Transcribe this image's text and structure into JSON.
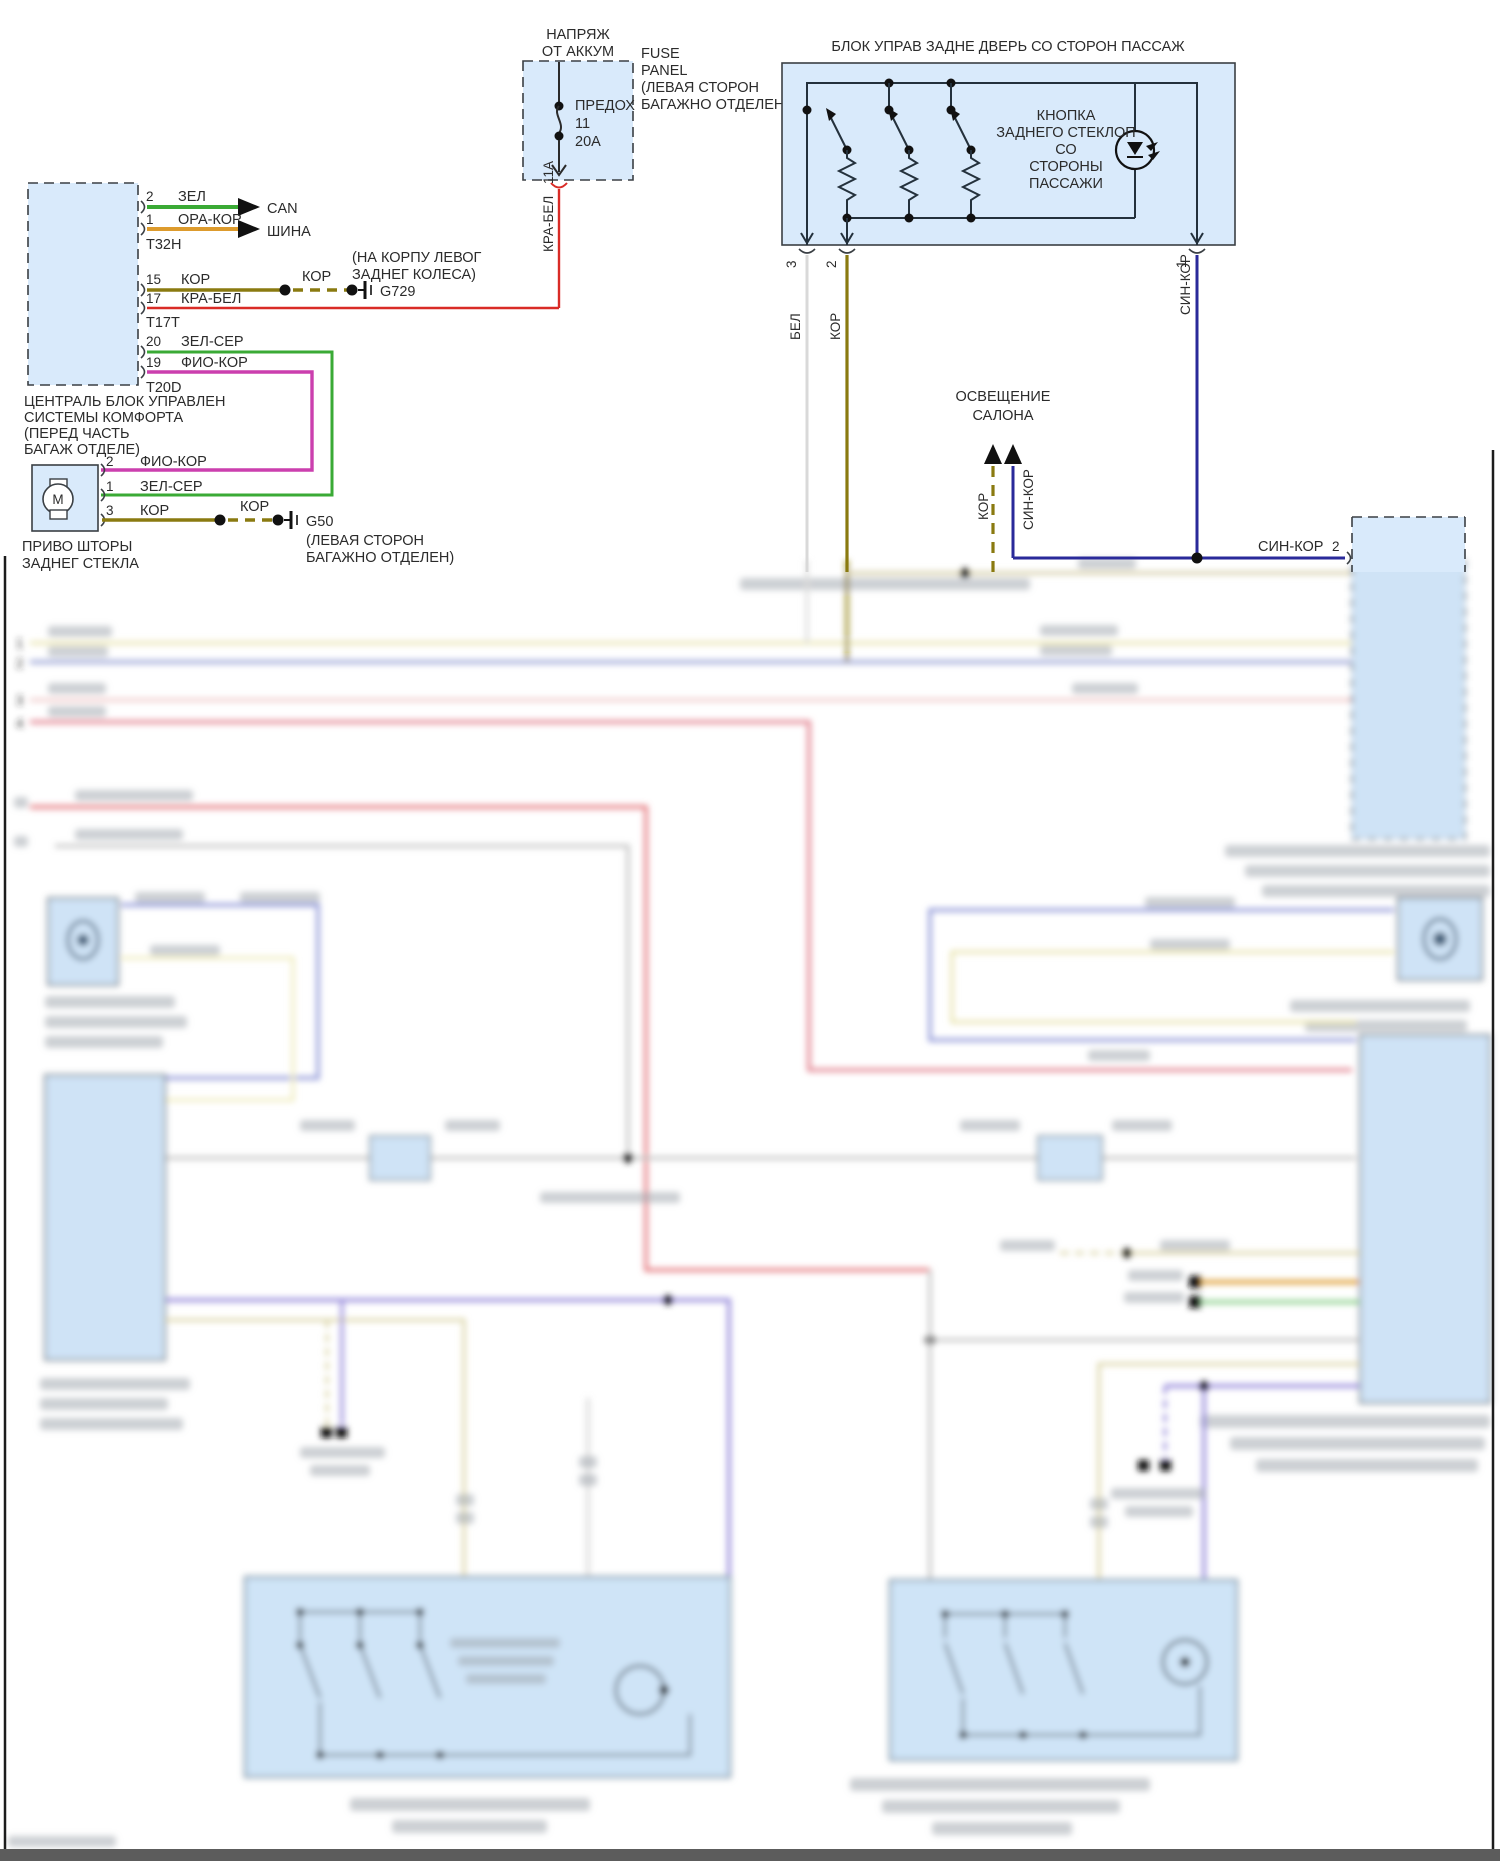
{
  "colors": {
    "green": "#3aaa35",
    "orange": "#dd9b2d",
    "olive": "#8a7a10",
    "red": "#d92b26",
    "magenta": "#cb3fae",
    "blue": "#2a2a9a",
    "white_wire": "#d9d9d9",
    "block_fill": "#d9eafb",
    "blur_fill": "#cfe3f6",
    "row_yellow": "#e6e1a6",
    "row_periwinkle": "#96a0d4",
    "row_palepink": "#efc7c7",
    "row_crimson": "#e2808e",
    "row_red": "#e2696f",
    "row_gray": "#bcbcbc",
    "violet": "#8d80d8",
    "beige": "#d9d2a2"
  },
  "fuse_panel": {
    "supply": [
      "НАПРЯЖ",
      "ОТ АККУМ"
    ],
    "fuse": [
      "ПРЕДОХ",
      "11",
      "20А"
    ],
    "panel": [
      "FUSE",
      "PANEL",
      "(ЛЕВАЯ СТОРОН",
      "БАГАЖНО ОТДЕЛЕН)"
    ],
    "amp": "11А",
    "wire": "КРА-БЕЛ"
  },
  "comfort_block": {
    "title": [
      "ЦЕНТРАЛЬ БЛОК УПРАВЛЕН",
      "СИСТЕМЫ КОМФОРТА",
      "(ПЕРЕД ЧАСТЬ",
      "БАГАЖ ОТДЕЛЕ)"
    ],
    "conn1": "T32H",
    "conn2": "T17T",
    "conn3": "T20D",
    "pins": {
      "p2": "2",
      "p1": "1",
      "p15": "15",
      "p17": "17",
      "p20": "20",
      "p19": "19"
    },
    "wires": {
      "w2": "ЗЕЛ",
      "w1": "ОРА-КОР",
      "w15": "КОР",
      "w17": "КРА-БЕЛ",
      "w20": "ЗЕЛ-СЕР",
      "w19": "ФИО-КОР"
    },
    "bus": [
      "CAN",
      "ШИНА"
    ],
    "ground": {
      "label": "КОР",
      "name": "G729",
      "note": [
        "(НА КОРПУ ЛЕВОГ",
        "ЗАДНЕГ КОЛЕСА)"
      ]
    }
  },
  "motor": {
    "symbol": "M",
    "title": [
      "ПРИВО ШТОРЫ",
      "ЗАДНЕГ СТЕКЛА"
    ],
    "pins": {
      "p2": "2",
      "p1": "1",
      "p3": "3"
    },
    "wires": {
      "w2": "ФИО-КОР",
      "w1": "ЗЕЛ-СЕР",
      "w3": "КОР"
    },
    "ground": {
      "label": "КОР",
      "name": "G50",
      "note": [
        "(ЛЕВАЯ СТОРОН",
        "БАГАЖНО ОТДЕЛЕН)"
      ]
    }
  },
  "door_block": {
    "title": "БЛОК УПРАВ ЗАДНЕ ДВЕРЬ СО СТОРОН ПАССАЖ",
    "button": [
      "КНОПКА",
      "ЗАДНЕГО СТЕКЛОП",
      "СО",
      "СТОРОНЫ",
      "ПАССАЖИ"
    ],
    "pins": {
      "p3": "3",
      "p2": "2",
      "p1": "1"
    },
    "wires": {
      "w3": "БЕЛ",
      "w2": "КОР",
      "w1": "СИН-КОР"
    }
  },
  "salon": {
    "title": [
      "ОСВЕЩЕНИЕ",
      "САЛОНА"
    ],
    "wires": {
      "w1": "КОР",
      "w2": "СИН-КОР"
    }
  },
  "right_conn": {
    "wire": "СИН-КОР",
    "pin": "2"
  },
  "rows": {
    "n1": "1",
    "n2": "2",
    "n3": "3",
    "n4": "4"
  }
}
